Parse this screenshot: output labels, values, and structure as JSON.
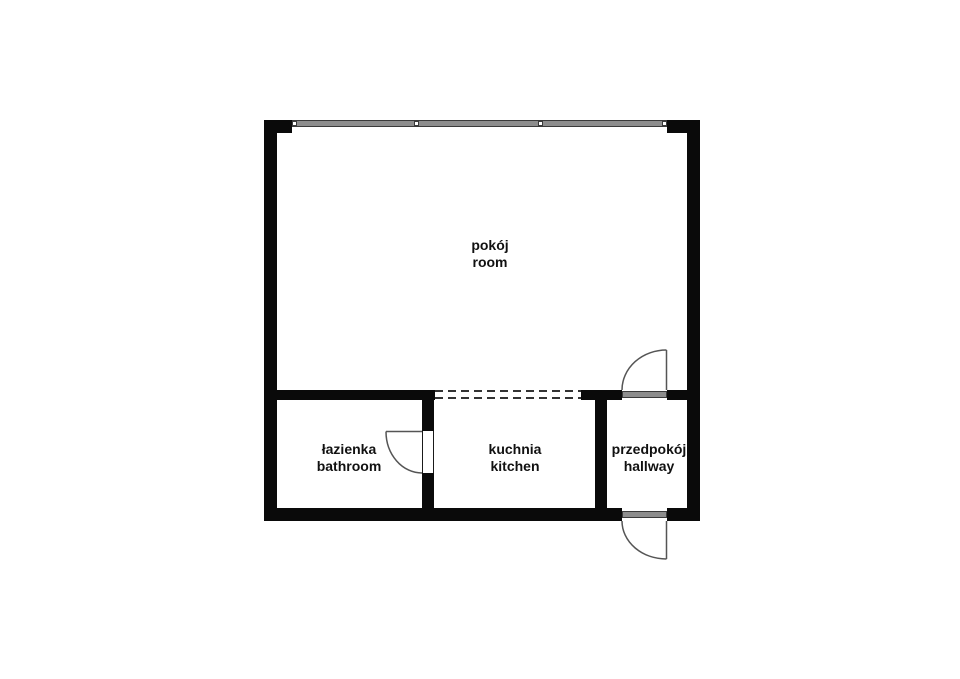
{
  "plan_title": "studio apartment floor plan",
  "colors": {
    "bg": "#ffffff",
    "wall": "#0a0a0a",
    "window-fill": "#8d8d8d",
    "window-edge": "#3a3a3a",
    "door-line": "#555555",
    "label": "#111111"
  },
  "rooms": [
    {
      "id": "pokoj",
      "label_pl": "pokój",
      "label_en": "room"
    },
    {
      "id": "lazienka",
      "label_pl": "łazienka",
      "label_en": "bathroom"
    },
    {
      "id": "kuchnia",
      "label_pl": "kuchnia",
      "label_en": "kitchen"
    },
    {
      "id": "przedpokoj",
      "label_pl": "przedpokój",
      "label_en": "hallway"
    }
  ],
  "windows": [
    {
      "location": "top exterior wall of pokój",
      "panes": 3
    }
  ],
  "doors": [
    {
      "from": "kuchnia",
      "to": "łazienka",
      "swing": "into bathroom"
    },
    {
      "from": "pokój",
      "to": "przedpokój",
      "swing": "into room"
    },
    {
      "from": "przedpokój",
      "to": "outside",
      "swing": "outward",
      "type": "entrance"
    }
  ],
  "openings": [
    {
      "from": "pokój",
      "to": "kuchnia",
      "type": "open passage (dashed)"
    }
  ]
}
